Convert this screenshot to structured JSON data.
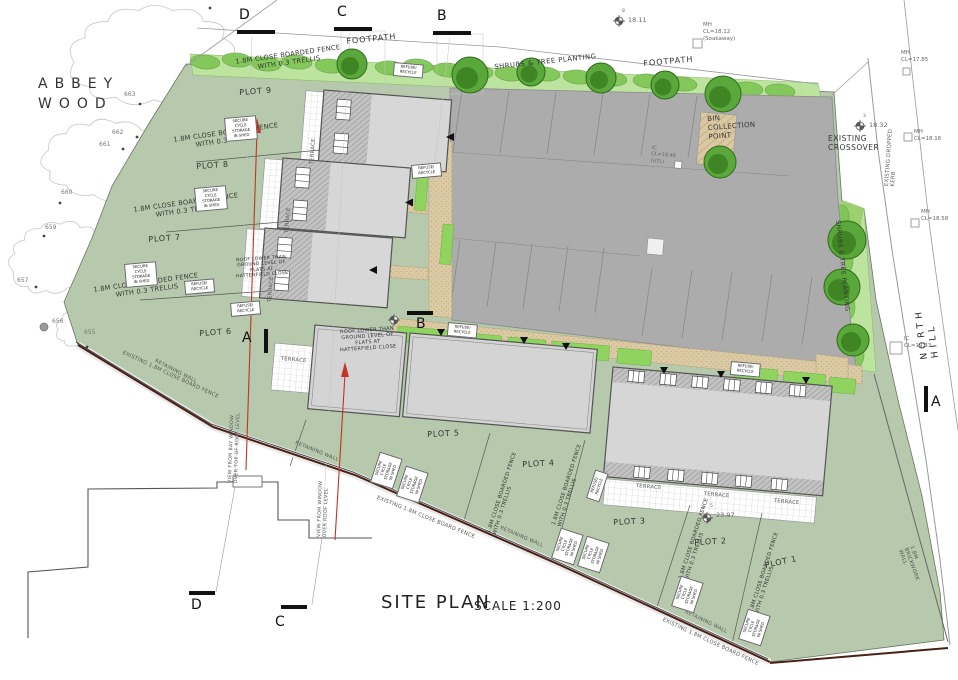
{
  "area": {
    "name_line1": "ABBEY",
    "name_line2": "WOOD"
  },
  "titleblock": {
    "title": "SITE PLAN",
    "scale": "SCALE 1:200"
  },
  "roads": {
    "name_vertical": "NORTH HILL",
    "footpath_west": "FOOTPATH",
    "footpath_east": "FOOTPATH",
    "dropped_kerb": "EXISTING DROPPED KERB",
    "crossover": "EXISTING\nCROSSOVER"
  },
  "landscape": {
    "shrubs_top": "SHRUBS & TREE PLANTING",
    "shrubs_east": "SHRUBS & TREE PLANTING",
    "bin_point": "BIN\nCOLLECTION\nPOINT"
  },
  "plots": {
    "p1": "PLOT 1",
    "p2": "PLOT 2",
    "p3": "PLOT 3",
    "p4": "PLOT 4",
    "p5": "PLOT 5",
    "p6": "PLOT 6",
    "p7": "PLOT 7",
    "p8": "PLOT 8",
    "p9": "PLOT 9"
  },
  "fences": {
    "boarded_trellis": "1.8M CLOSE BOARDED FENCE\nWITH 0.3 TRELLIS",
    "existing_board": "EXISTING 1.8M CLOSE BOARD FENCE",
    "retaining_wall": "RETAINING WALL",
    "brickwork_wall": "1.8M BRICKWORK WALL"
  },
  "annotations": {
    "cycle_store": "SECURE\nCYCLE\nSTORAGE\nIN SHED",
    "refuse": "REFUSE/\nRECYCLE",
    "terrace": "TERRACE",
    "roof_lower": "ROOF LOWER THAN\nGROUND LEVEL OF\nFLATS AT\nHATTERFIELD CLOSE",
    "view_bay": "VIEW FROM BAY WINDOW\nOVER TOP OF ROOF LEVEL",
    "view_window": "VIEW FROM WINDOW\nOVER ROOF LEVEL"
  },
  "sections": {
    "a": "A",
    "b": "B",
    "c": "C",
    "d": "D"
  },
  "levels": {
    "bm1": {
      "sup": "8",
      "val": "18.11"
    },
    "bm2": {
      "sup": "3",
      "val": "18.32"
    },
    "bm3": {
      "sup": "5",
      "val": "23.97"
    },
    "mh_soakaway": "MH\nCL=18.12\n(Soakaway)",
    "mh_1785": "MH\nCL=17.85",
    "mh_1816": "MH\nCL=18.16",
    "mh_1858": "MH\nCL=18.58",
    "ic_1933": "IC\nCL=19.33",
    "ic_1848": "IC\nCL=18.48\n(UTL)"
  },
  "tree_points": {
    "n655": "655",
    "n656": "656",
    "n657": "657",
    "n659": "659",
    "n660": "660",
    "n661": "661",
    "n662": "662",
    "n663": "663"
  },
  "colors": {
    "site_green": "#b6c9ac",
    "shrub_band": "#bce49e",
    "shrub_dark": "#7fc556",
    "tree_fill": "#5aa83c",
    "tree_inner": "#3f8524",
    "parking": "#acacac",
    "roof": "#d7d7d7",
    "path": "#d9c8a2",
    "boundary": "#4a2015",
    "arrow": "#c43327"
  }
}
